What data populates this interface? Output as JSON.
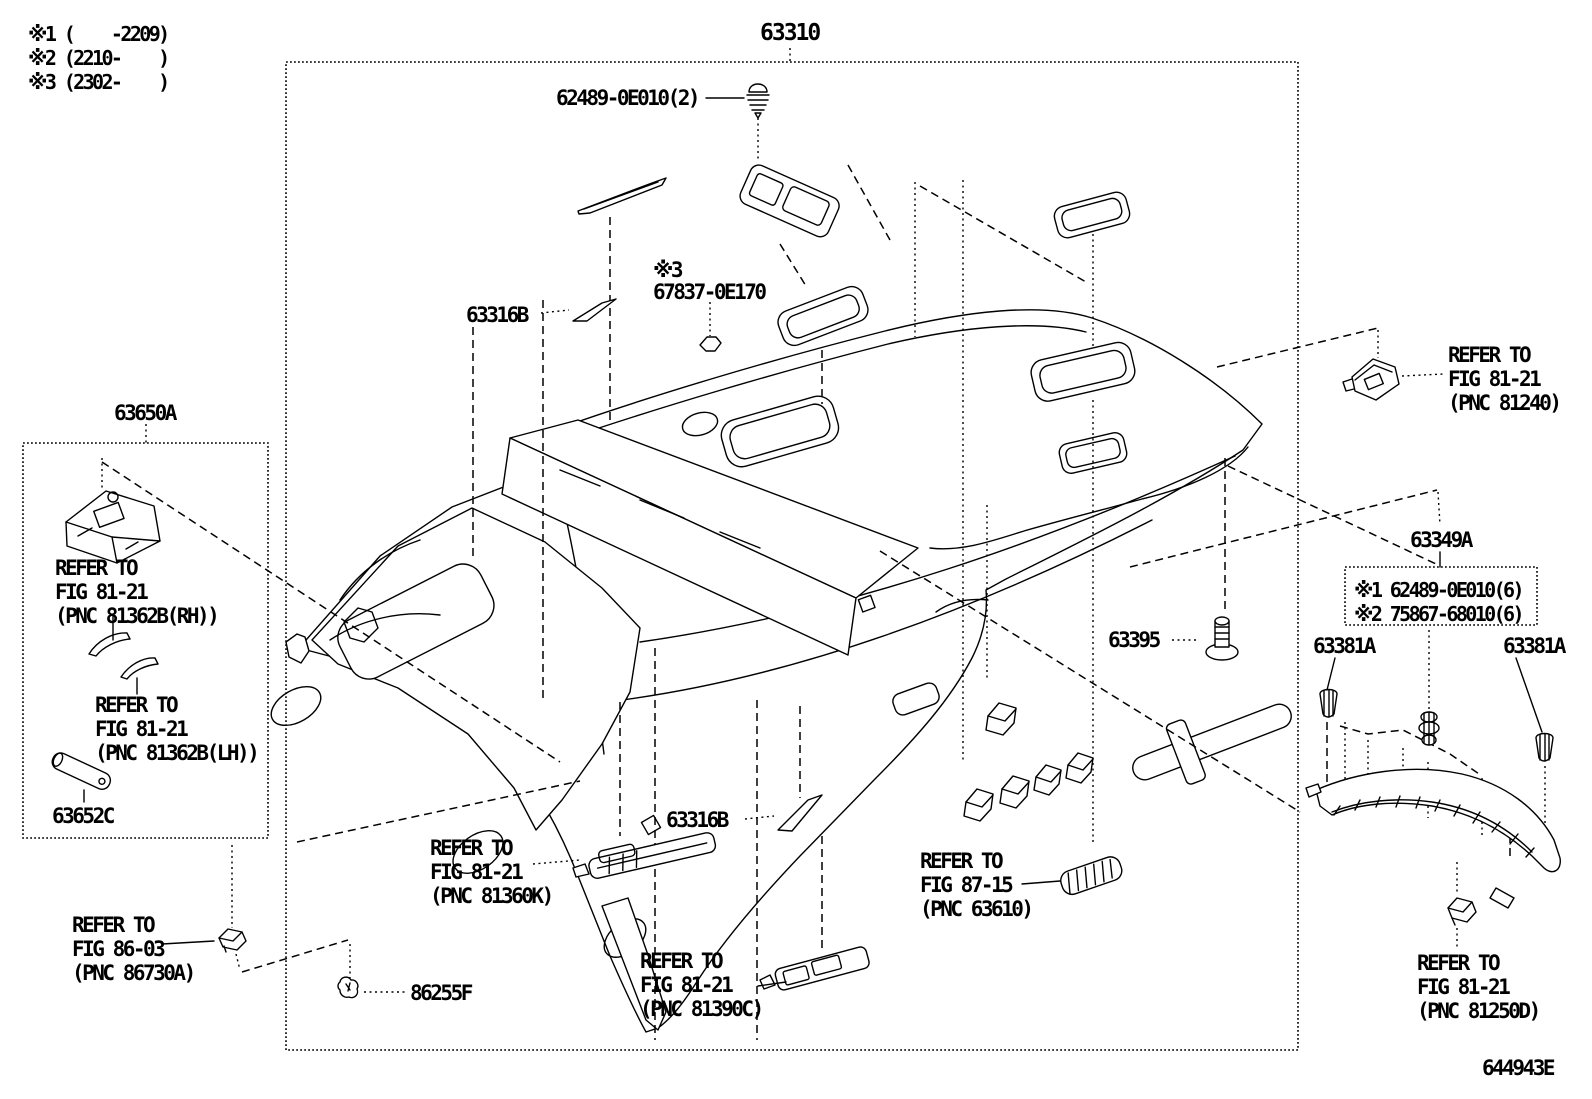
{
  "doc": {
    "drawing_code": "644943E",
    "notes": "※1 (    -2209)\n※2 (2210-    )\n※3 (2302-    )"
  },
  "labels": {
    "main_assembly": "63310",
    "p62489": "62489-0E010(2)",
    "p63316b_1": "63316B",
    "p67837": "※3\n67837-0E170",
    "p63650a": "63650A",
    "ref_81362b_rh": "REFER TO\nFIG 81-21\n(PNC 81362B(RH))",
    "ref_81362b_lh": "REFER TO\nFIG 81-21\n(PNC 81362B(LH))",
    "p63652c": "63652C",
    "ref_86730a": "REFER TO\nFIG 86-03\n(PNC 86730A)",
    "p86255f": "86255F",
    "ref_81360k": "REFER TO\nFIG 81-21\n(PNC 81360K)",
    "p63316b_2": "63316B",
    "ref_81390c": "REFER TO\nFIG 81-21\n(PNC 81390C)",
    "ref_63610": "REFER TO\nFIG 87-15\n(PNC 63610)",
    "p63395": "63395",
    "ref_81240": "REFER TO\nFIG 81-21\n(PNC 81240)",
    "p63349a": "63349A",
    "clip_notes": "※1 62489-0E010(6)\n※2 75867-68010(6)",
    "p63381a_l": "63381A",
    "p63381a_r": "63381A",
    "ref_81250d": "REFER TO\nFIG 81-21\n(PNC 81250D)"
  }
}
